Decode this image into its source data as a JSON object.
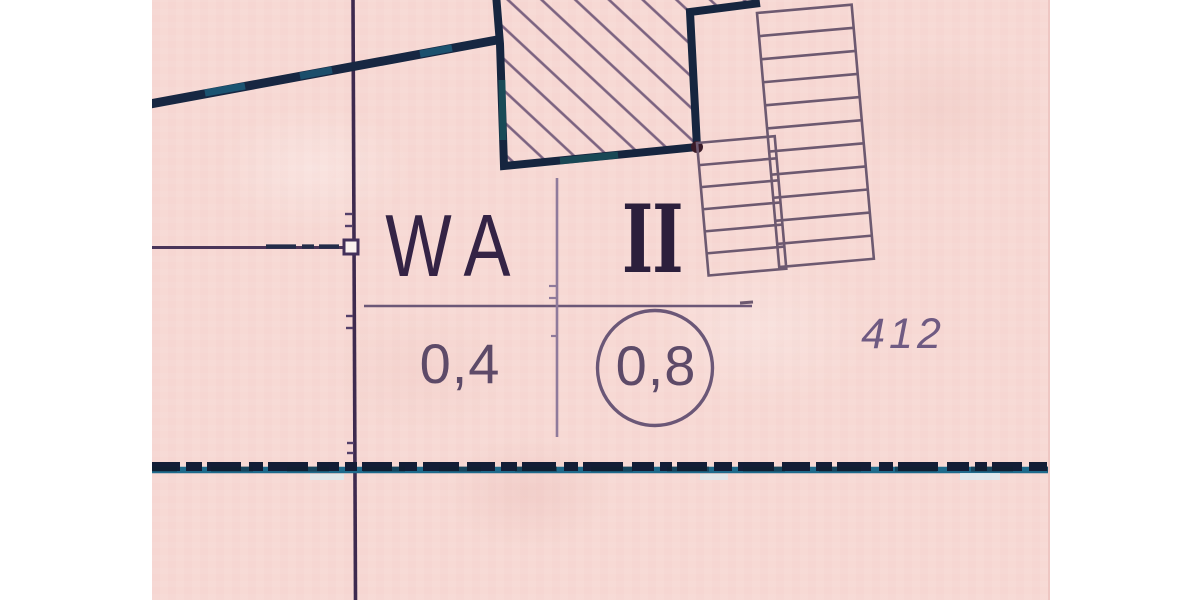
{
  "plan": {
    "use_template": {
      "area_use_label": "WA",
      "storeys_numeral": "II",
      "value_left": "0,4",
      "value_circled": "0,8"
    },
    "parcel_number": "412",
    "symbols": {
      "building_hatch": "proposed-building-hatched-area",
      "ladder_blocks": "existing-building-stair-rows",
      "boundary_band": "plan-area-boundary-dashed-band",
      "boundary_node": "parcel-boundary-node-square"
    },
    "colors": {
      "paper": "#f7d9d4",
      "margin": "#ffffff",
      "ink_heavy": "#16253f",
      "ink_teal": "#1f6b8c",
      "ink_text_dark": "#342345",
      "ink_numeral": "#2c1f3c",
      "ink_values": "#5d4a68",
      "ink_thin": "#6b5777",
      "ink_ladder": "#6d5970",
      "ink_parcel": "#6f5a82",
      "ink_boundary_line": "#3e2b4f"
    }
  }
}
